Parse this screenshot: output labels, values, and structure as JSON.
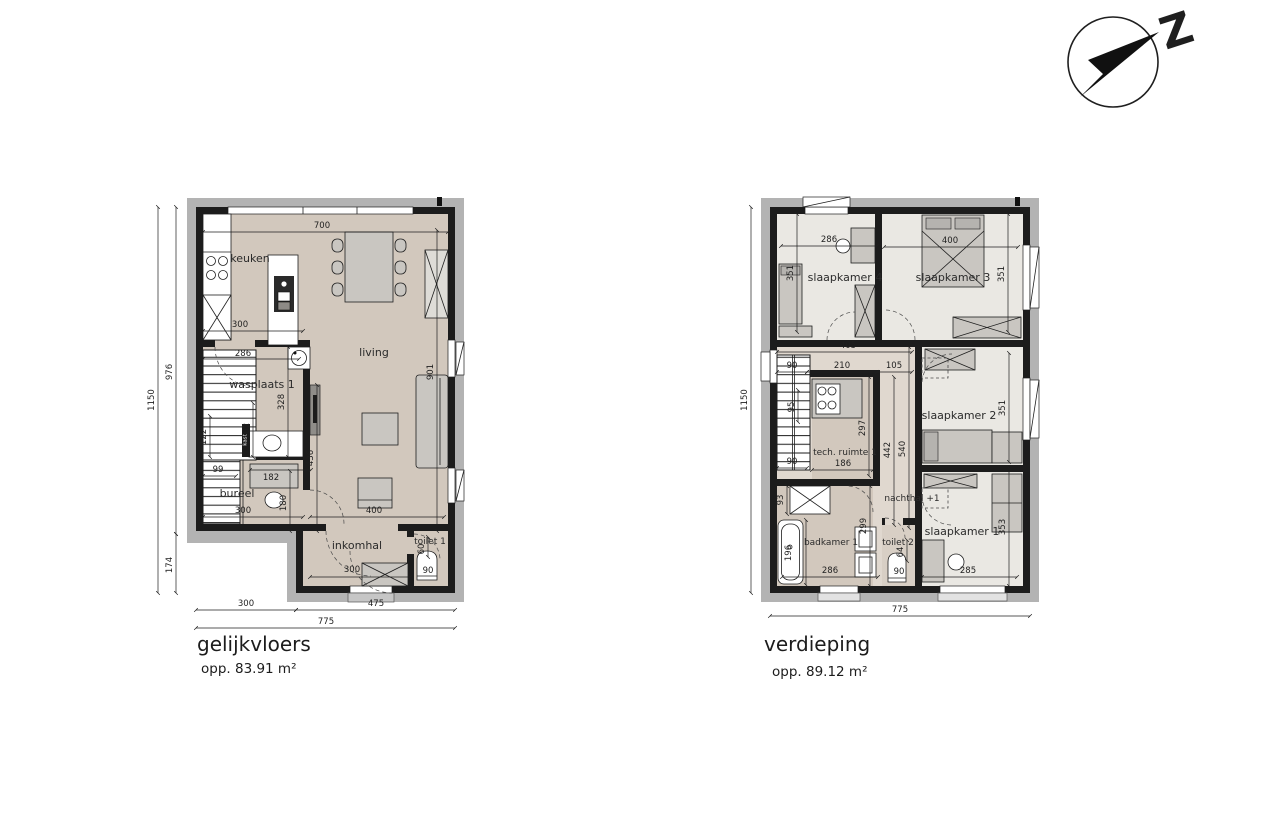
{
  "compass": {
    "label": "Z"
  },
  "gf": {
    "title": "gelijkvloers",
    "area": "opp. 83.91 m²",
    "rooms": {
      "keuken": "keuken",
      "living": "living",
      "wasplaats": "wasplaats 1",
      "bureel": "bureel",
      "inkomhal": "inkomhal",
      "toilet": "toilet 1",
      "kast": "kast"
    },
    "dims": {
      "d1150": "1150",
      "d976": "976",
      "d174": "174",
      "d300bottom": "300",
      "d475": "475",
      "d775": "775",
      "d700": "700",
      "d300keuken": "300",
      "d286": "286",
      "d328": "328",
      "d162": "162",
      "d122": "122",
      "d99": "99",
      "d436": "436",
      "d901": "901",
      "d182": "182",
      "d180": "180",
      "d300bureel": "300",
      "d400": "400",
      "d300inkomhal": "300",
      "d60": "60",
      "d90": "90"
    }
  },
  "fl": {
    "title": "verdieping",
    "area": "opp. 89.12 m²",
    "rooms": {
      "sk4": "slaapkamer 4",
      "sk3": "slaapkamer 3",
      "sk2": "slaapkamer 2",
      "sk1": "slaapkamer 1",
      "tech": "tech. ruimte 1",
      "nachthal": "nachthal +1",
      "badkamer": "badkamer 1",
      "toilet": "toilet 2"
    },
    "dims": {
      "d1150": "1150",
      "d775": "775",
      "d286sk4": "286",
      "d400": "400",
      "d351sk4": "351",
      "d351sk3": "351",
      "d351sk2": "351",
      "d353": "353",
      "d405": "405",
      "d90stairs": "90",
      "d210": "210",
      "d105": "105",
      "d95": "95",
      "d90stairs2": "90",
      "d297": "297",
      "d186": "186",
      "d442": "442",
      "d540": "540",
      "d299": "299",
      "d93": "93",
      "d196": "196",
      "d286bad": "286",
      "d64": "64",
      "d90wc": "90",
      "d285": "285"
    }
  }
}
